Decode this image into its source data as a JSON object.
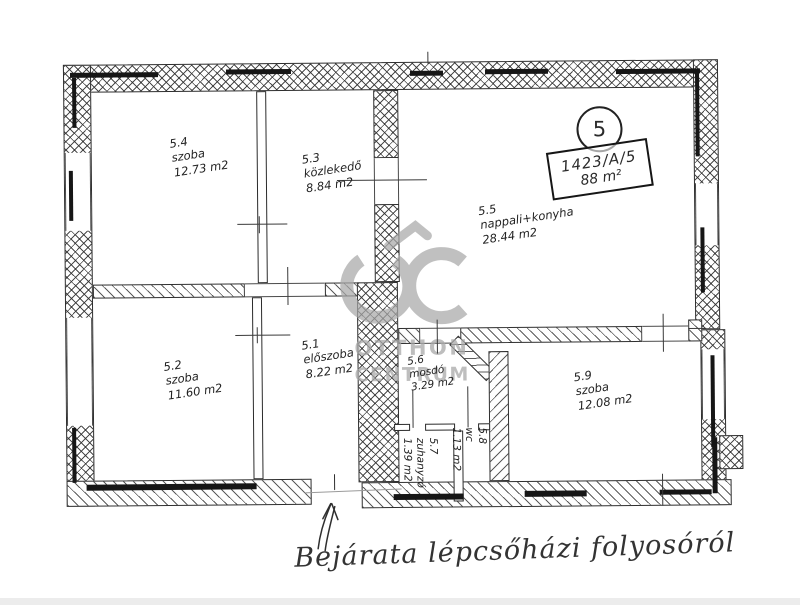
{
  "document": {
    "unit_number": "5",
    "lot_number": "1423/A/5",
    "total_area": "88 m²",
    "caption": "Bejárata lépcsőházi folyosóról"
  },
  "watermark": {
    "logo": "OC",
    "line1": "OTTHON",
    "line2": "CENTRUM",
    "color": "#a9a9a9"
  },
  "rooms": [
    {
      "id": "5.1",
      "name": "előszoba",
      "area": "8.22 m2"
    },
    {
      "id": "5.2",
      "name": "szoba",
      "area": "11.60 m2"
    },
    {
      "id": "5.3",
      "name": "közlekedő",
      "area": "8.84 m2"
    },
    {
      "id": "5.4",
      "name": "szoba",
      "area": "12.73 m2"
    },
    {
      "id": "5.5",
      "name": "nappali+konyha",
      "area": "28.44 m2"
    },
    {
      "id": "5.6",
      "name": "mosdó",
      "area": "3.29 m2"
    },
    {
      "id": "5.7",
      "name": "zuhanyzó",
      "area": "1.39 m2"
    },
    {
      "id": "5.8",
      "name": "wc",
      "area": "1.13 m2"
    },
    {
      "id": "5.9",
      "name": "szoba",
      "area": "12.08 m2"
    }
  ],
  "colors": {
    "ink": "#2b2b2b",
    "watermark": "#a9a9a9"
  }
}
